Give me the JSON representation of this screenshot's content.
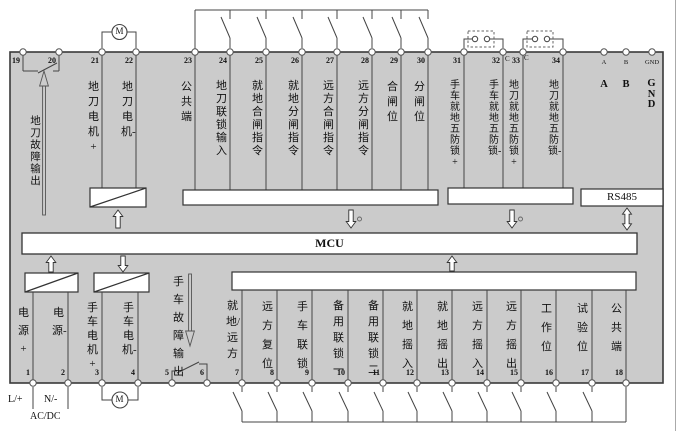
{
  "diagram": {
    "mcu": "MCU",
    "rs485": "RS485",
    "motor": "M",
    "c_mark": "C"
  },
  "power": {
    "line": "L/+",
    "neutral": "N/-",
    "type": "AC/DC"
  },
  "annotations": {
    "top_fault": "地刀故障输出",
    "bottom_fault": "手车故障输出"
  },
  "comm": {
    "pins": [
      "A",
      "B",
      "GND"
    ]
  },
  "top_terminals": [
    {
      "num": "19",
      "label": ""
    },
    {
      "num": "20",
      "label": ""
    },
    {
      "num": "21",
      "label": "地刀电机+"
    },
    {
      "num": "22",
      "label": "地刀电机-"
    },
    {
      "num": "23",
      "label": "公共端"
    },
    {
      "num": "24",
      "label": "地刀联锁输入"
    },
    {
      "num": "25",
      "label": "就地合闸指令"
    },
    {
      "num": "26",
      "label": "就地分闸指令"
    },
    {
      "num": "27",
      "label": "远方合闸指令"
    },
    {
      "num": "28",
      "label": "远方分闸指令"
    },
    {
      "num": "29",
      "label": "合闸位"
    },
    {
      "num": "30",
      "label": "分闸位"
    },
    {
      "num": "31",
      "label": "手车就地五防锁+"
    },
    {
      "num": "32",
      "label": "手车就地五防锁-"
    },
    {
      "num": "33",
      "label": "地刀就地五防锁+"
    },
    {
      "num": "34",
      "label": "地刀就地五防锁-"
    }
  ],
  "bottom_terminals": [
    {
      "num": "1",
      "label": "电源+"
    },
    {
      "num": "2",
      "label": "电源-"
    },
    {
      "num": "3",
      "label": "手车电机+"
    },
    {
      "num": "4",
      "label": "手车电机-"
    },
    {
      "num": "5",
      "label": ""
    },
    {
      "num": "6",
      "label": ""
    },
    {
      "num": "7",
      "label": "就地/远方"
    },
    {
      "num": "8",
      "label": "远方复位"
    },
    {
      "num": "9",
      "label": "手车联锁"
    },
    {
      "num": "10",
      "label": "备用联锁一"
    },
    {
      "num": "11",
      "label": "备用联锁二"
    },
    {
      "num": "12",
      "label": "就地摇入"
    },
    {
      "num": "13",
      "label": "就地摇出"
    },
    {
      "num": "14",
      "label": "远方摇入"
    },
    {
      "num": "15",
      "label": "远方摇出"
    },
    {
      "num": "16",
      "label": "工作位"
    },
    {
      "num": "17",
      "label": "试验位"
    },
    {
      "num": "18",
      "label": "公共端"
    }
  ],
  "colors": {
    "panel": "#cbcbcb",
    "wire": "#444444",
    "box_fill": "#ffffff"
  }
}
